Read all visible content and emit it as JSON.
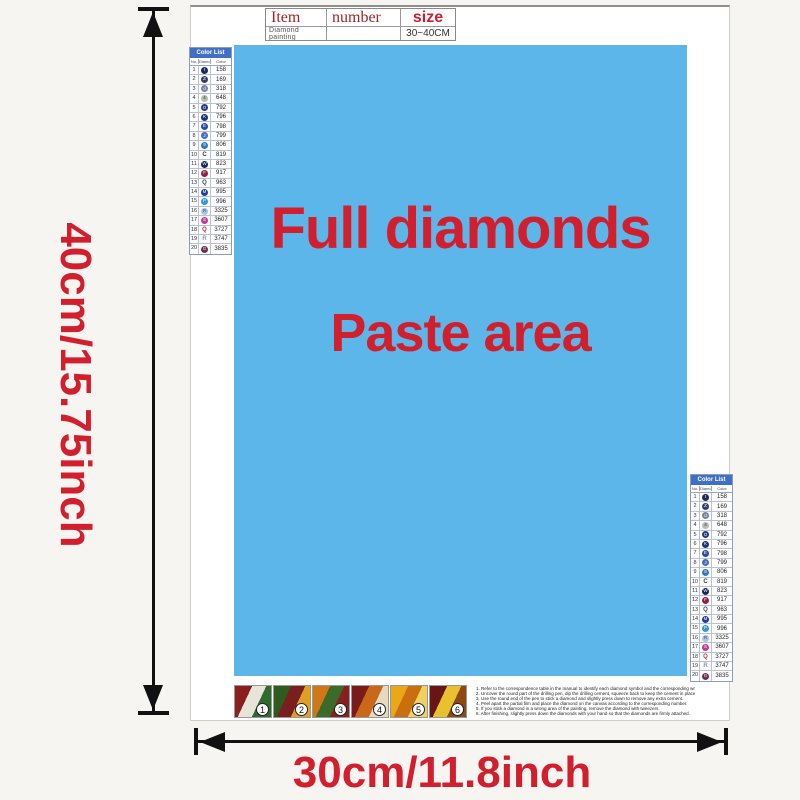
{
  "colors": {
    "accent_red": "#d11f2e",
    "paste_blue": "#5cb6e9",
    "table_header_blue": "#3f6fc6",
    "arrow_black": "#111111"
  },
  "item_table": {
    "col_item": "Item",
    "col_number": "number",
    "col_size": "size",
    "row_item": "Diamond painting",
    "row_number": "",
    "row_size": "30~40CM"
  },
  "paste_area": {
    "line1": "Full diamonds",
    "line2": "Paste area"
  },
  "dimensions": {
    "height_label": "40cm/15.75inch",
    "width_label": "30cm/11.8inch"
  },
  "color_list": {
    "title": "Color List",
    "headers": [
      "No.",
      "Diamond",
      "Color"
    ],
    "rows": [
      {
        "no": "1",
        "code": "158",
        "sym": "circle",
        "color": "#1b2960",
        "glyph": "t",
        "glyph_color": "#ffffff"
      },
      {
        "no": "2",
        "code": "169",
        "sym": "circle",
        "color": "#35406e",
        "glyph": "Z",
        "glyph_color": "#ffffff"
      },
      {
        "no": "3",
        "code": "318",
        "sym": "circle",
        "color": "#76829e",
        "glyph": "d",
        "glyph_color": "#ffffff"
      },
      {
        "no": "4",
        "code": "648",
        "sym": "circle",
        "color": "#b7bcb4",
        "glyph": "4",
        "glyph_color": "#333333"
      },
      {
        "no": "5",
        "code": "792",
        "sym": "circle",
        "color": "#273a86",
        "glyph": "O",
        "glyph_color": "#ffffff"
      },
      {
        "no": "6",
        "code": "796",
        "sym": "circle",
        "color": "#1d2f7e",
        "glyph": "K",
        "glyph_color": "#ffffff"
      },
      {
        "no": "7",
        "code": "798",
        "sym": "circle",
        "color": "#2c4aa6",
        "glyph": "E",
        "glyph_color": "#ffffff"
      },
      {
        "no": "8",
        "code": "799",
        "sym": "circle",
        "color": "#4a6cc0",
        "glyph": "J",
        "glyph_color": "#ffffff"
      },
      {
        "no": "9",
        "code": "806",
        "sym": "circle",
        "color": "#2f7cba",
        "glyph": "9",
        "glyph_color": "#ffffff"
      },
      {
        "no": "10",
        "code": "819",
        "sym": "letter",
        "color": "",
        "glyph": "C",
        "glyph_color": "#333344"
      },
      {
        "no": "11",
        "code": "823",
        "sym": "circle",
        "color": "#182758",
        "glyph": "W",
        "glyph_color": "#ffffff"
      },
      {
        "no": "12",
        "code": "917",
        "sym": "circle",
        "color": "#8e2248",
        "glyph": "F",
        "glyph_color": "#ffffff"
      },
      {
        "no": "13",
        "code": "963",
        "sym": "letter",
        "color": "",
        "glyph": "Q",
        "glyph_color": "#444455"
      },
      {
        "no": "14",
        "code": "995",
        "sym": "circle",
        "color": "#1e3d9e",
        "glyph": "M",
        "glyph_color": "#ffffff"
      },
      {
        "no": "15",
        "code": "996",
        "sym": "circle",
        "color": "#2f99d6",
        "glyph": "P",
        "glyph_color": "#ffffff"
      },
      {
        "no": "16",
        "code": "3325",
        "sym": "circle",
        "color": "#a9c4e2",
        "glyph": "R",
        "glyph_color": "#2a4a8a"
      },
      {
        "no": "17",
        "code": "3607",
        "sym": "circle",
        "color": "#c03a92",
        "glyph": "S",
        "glyph_color": "#ffffff"
      },
      {
        "no": "18",
        "code": "3727",
        "sym": "letter",
        "color": "",
        "glyph": "Q",
        "glyph_color": "#b03535"
      },
      {
        "no": "19",
        "code": "3747",
        "sym": "letter",
        "color": "",
        "glyph": "R",
        "glyph_color": "#8a92b2"
      },
      {
        "no": "20",
        "code": "3835",
        "sym": "circle",
        "color": "#6e2c50",
        "glyph": "G",
        "glyph_color": "#ffffff"
      }
    ]
  },
  "steps": [
    {
      "num": "1",
      "colors": [
        "#8a1f1f",
        "#e8e4da",
        "#2e6b2e"
      ]
    },
    {
      "num": "2",
      "colors": [
        "#2e5c1f",
        "#7a1f1f",
        "#e0a020"
      ]
    },
    {
      "num": "3",
      "colors": [
        "#d07818",
        "#3a6b28",
        "#8a1f1f"
      ]
    },
    {
      "num": "4",
      "colors": [
        "#7a1a1a",
        "#c86818",
        "#e8d8c0"
      ]
    },
    {
      "num": "5",
      "colors": [
        "#e8a818",
        "#c87010",
        "#f0d060"
      ]
    },
    {
      "num": "6",
      "colors": [
        "#6a1515",
        "#e8c030",
        "#8a4a10"
      ]
    }
  ],
  "instructions": {
    "lines": [
      "1. Refer to the correspondence table in the manual to identify each diamond symbol and the corresponding written number on the canvas.",
      "2. Uncover the round part of the drilling pen, dip the drilling cement, squeeze back to keep the cement in place.",
      "3. Use the round end of the pen to stick a diamond and slightly press down to remove any extra cement.",
      "4. Peel apart the partial film and place the diamond on the canvas according to the corresponding number.",
      "5. If you stick a diamond in a wrong area of the painting, remove the diamond with tweezers.",
      "6. After finishing, slightly press down the diamonds with your hand so that the diamonds are firmly attached."
    ]
  }
}
